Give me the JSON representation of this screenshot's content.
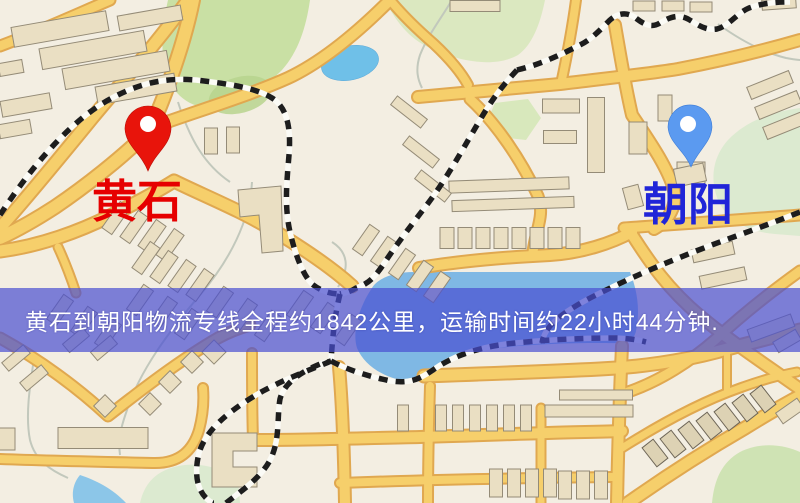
{
  "map": {
    "origin_label": "黄石",
    "destination_label": "朝阳",
    "origin_pin_color": "#e8140b",
    "destination_pin_color": "#5b9af0",
    "origin_label_color": "#e60000",
    "destination_label_color": "#2025d8"
  },
  "banner": {
    "text": "黄石到朝阳物流专线全程约1842公里，运输时间约22小时44分钟.",
    "background_color": "rgba(72,79,209,0.70)",
    "text_color": "#ffffff"
  },
  "route_info": {
    "origin": "黄石",
    "destination": "朝阳",
    "service": "物流专线",
    "distance_text": "全程约1842公里",
    "duration_text": "运输时间约22小时44分钟"
  }
}
